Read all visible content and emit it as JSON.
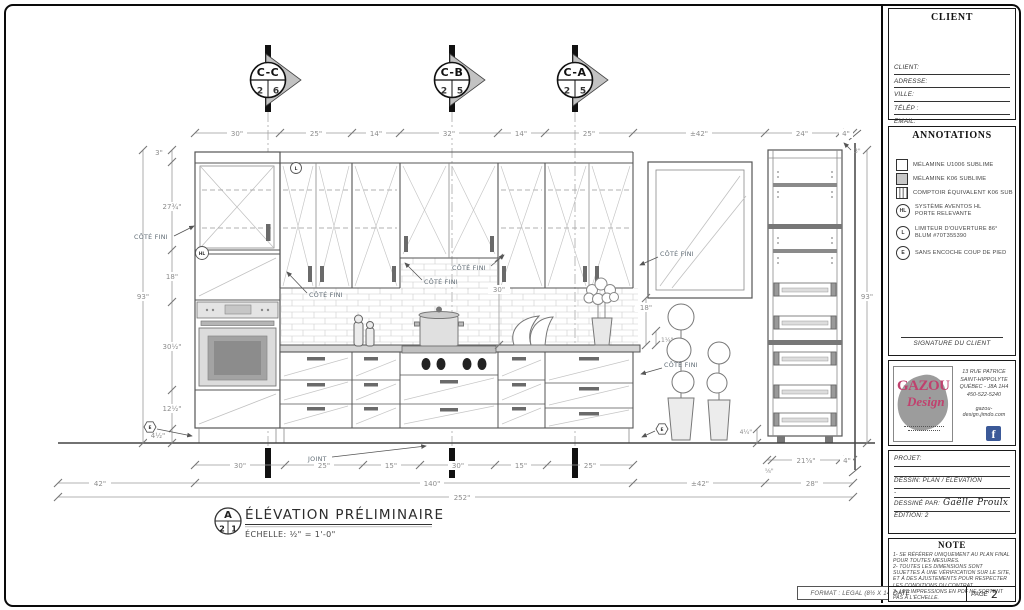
{
  "drawing": {
    "section_markers": [
      {
        "name": "C-C",
        "num": "2",
        "sheet": "6"
      },
      {
        "name": "C-B",
        "num": "2",
        "sheet": "5"
      },
      {
        "name": "C-A",
        "num": "2",
        "sheet": "5"
      }
    ],
    "dims": {
      "top": [
        "30\"",
        "25\"",
        "14\"",
        "32\"",
        "14\"",
        "25\"",
        "±42\"",
        "24\"",
        "4\""
      ],
      "top_leader": "3\"",
      "left_chain": [
        "3\"",
        "27¾\"",
        "18\"",
        "30½\"",
        "12½\"",
        "4½\""
      ],
      "left_total": "93\"",
      "right_total": "93\"",
      "hood_height": "30\"",
      "window_sill": "18\"",
      "counter_edge": "1¼\"",
      "bottom_run": [
        "30\"",
        "25\"",
        "15\"",
        "30\"",
        "15\"",
        "25\""
      ],
      "pantry_bottom": [
        "⅝\"",
        "21⅝\"",
        "4\""
      ],
      "pantry_toe": "4¼\"",
      "bottom_overall": [
        "42\"",
        "140\"",
        "±42\"",
        "28\""
      ],
      "bottom_total": "252\""
    },
    "labels": {
      "cote_fini": "CÔTÉ FINI",
      "joint": "JOINT",
      "hl": "HL",
      "l": "L",
      "e": "E"
    },
    "title": {
      "bubble_letter": "A",
      "bubble_num": "2",
      "bubble_sheet": "1",
      "text": "ÉLÉVATION PRÉLIMINAIRE",
      "scale": "ÉCHELLE: ½\" = 1'-0\""
    },
    "format_stamp": "FORMAT : LEGAL (8½ X 14)"
  },
  "titleblock": {
    "client": {
      "title": "CLIENT",
      "fields": [
        "CLIENT:",
        "ADRESSE:",
        "VILLE:",
        "TÉLÉP :",
        "EMAIL:"
      ]
    },
    "annotations": {
      "title": "ANNOTATIONS",
      "materials": [
        {
          "label": "MÉLAMINE U1006 SUBLIME"
        },
        {
          "label": "MÉLAMINE K06 SUBLIME"
        },
        {
          "label": "COMPTOIR ÉQUIVALENT K06 SUB"
        }
      ],
      "symbols": [
        {
          "symbol": "HL",
          "line1": "SYSTÈME AVENTOS HL",
          "line2": "PORTE RELEVANTE"
        },
        {
          "symbol": "L",
          "line1": "LIMITEUR D'OUVERTURE 86°",
          "line2": "BLUM #70T355390"
        },
        {
          "symbol": "E",
          "line1": "SANS ENCOCHE COUP DE PIED",
          "line2": ""
        }
      ],
      "signature": "SIGNATURE DU CLIENT"
    },
    "logo": {
      "name_top": "GAZOU",
      "name_bottom": "Design",
      "address": [
        "13 RUE PATRICE",
        "SAINT-HIPPOLYTE",
        "QUÉBEC - J8A 1H4",
        "450-522-5240"
      ],
      "website": "gazou-design.jimdo.com",
      "facebook_letter": "f"
    },
    "project": {
      "projet": "PROJET:",
      "dessin": "DESSIN: PLAN / ÉLÉVATION",
      "dash": "-",
      "par_label": "DESSINÉ PAR:",
      "par_value": "Gaëlle Proulx",
      "edition": "ÉDITION: 2"
    },
    "note": {
      "title": "NOTE",
      "items": [
        "1- SE RÉFÉRER UNIQUEMENT AU PLAN FINAL POUR TOUTES MESURES.",
        "2- TOUTES LES DIMENSIONS SONT SUJETTES À UNE VÉRIFICATION SUR LE SITE, ET À DES AJUSTEMENTS POUR RESPECTER LES CONDITIONS DU CONTRAT.",
        "3- LES IMPRESSIONS EN PDF NE SORTENT PAS À L'ÉCHELLE."
      ],
      "date_label": "DATE",
      "page_label": "PAGE",
      "page_value": "2"
    }
  },
  "colors": {
    "accent_pink": "#c0416e",
    "facebook_blue": "#3b5998",
    "line_gray": "#8c8c8c"
  }
}
